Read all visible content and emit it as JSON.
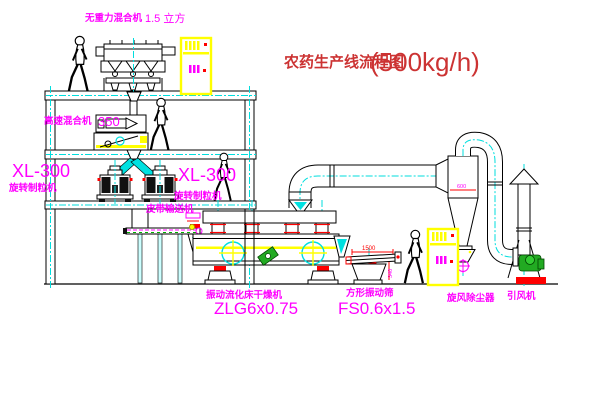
{
  "title": {
    "name_cn": "农药生产线流程图",
    "capacity": "(500kg/h)"
  },
  "equipment_labels": {
    "gravity_mixer_name": "无重力混合机",
    "gravity_mixer_capacity": "1.5 立方",
    "high_speed_mixer_name": "高速混合机",
    "high_speed_mixer_capacity": "350",
    "granulator_left_model": "XL-300",
    "granulator_left_name": "旋转制粒机",
    "granulator_right_model": "XL-300",
    "granulator_right_name": "旋转制粒机",
    "belt_conveyor": "皮带输送机",
    "fluid_bed_dryer_name": "振动流化床干燥机",
    "fluid_bed_dryer_model": "ZLG6x0.75",
    "vibrating_screen_name": "方形振动筛",
    "vibrating_screen_model": "FS0.6x1.5",
    "cyclone_name": "旋风除尘器",
    "fan_name": "引风机"
  },
  "dimensions": {
    "screen_length": "1500",
    "screen_height": "340",
    "cyclone_diameter": "600"
  },
  "colors": {
    "label_magenta": "#ff00ff",
    "title_red": "#cc3333",
    "dimension_red": "#ff0000",
    "cabinet_yellow": "#ffff00",
    "centerline_cyan": "#00dede",
    "fan_green": "#22aa22",
    "base_red": "#ff0000",
    "line_black": "#000000"
  }
}
